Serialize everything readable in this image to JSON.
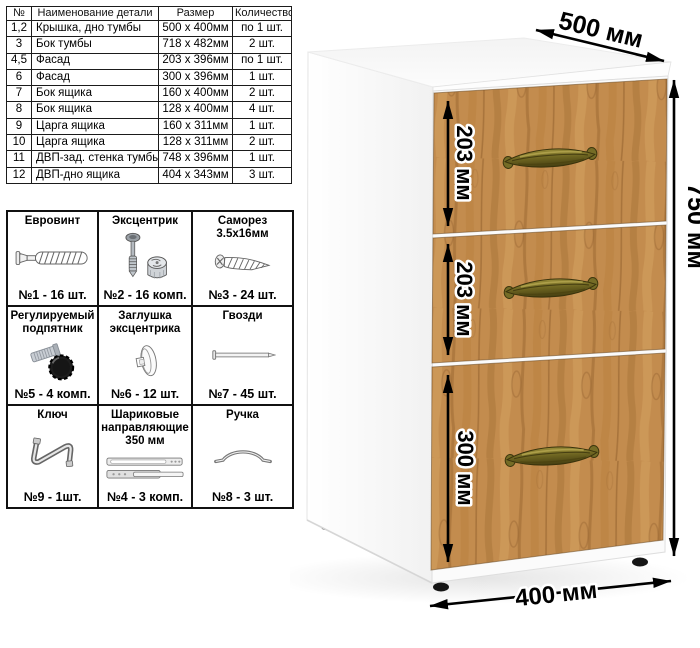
{
  "parts_table": {
    "headers": [
      "№",
      "Наименование детали",
      "Размер",
      "Количество"
    ],
    "rows": [
      [
        "1,2",
        "Крышка, дно тумбы",
        "500 х 400мм",
        "по 1 шт."
      ],
      [
        "3",
        "Бок тумбы",
        "718 х 482мм",
        "2 шт."
      ],
      [
        "4,5",
        "Фасад",
        "203 х 396мм",
        "по 1 шт."
      ],
      [
        "6",
        "Фасад",
        "300 х 396мм",
        "1 шт."
      ],
      [
        "7",
        "Бок ящика",
        "160 х 400мм",
        "2 шт."
      ],
      [
        "8",
        "Бок ящика",
        "128 х 400мм",
        "4 шт."
      ],
      [
        "9",
        "Царга ящика",
        "160 х 311мм",
        "1 шт."
      ],
      [
        "10",
        "Царга ящика",
        "128 х 311мм",
        "2 шт."
      ],
      [
        "11",
        "ДВП-зад. стенка тумбы",
        "748 х 396мм",
        "1 шт."
      ],
      [
        "12",
        "ДВП-дно ящика",
        "404 х 343мм",
        "3 шт."
      ]
    ]
  },
  "hardware": {
    "items": [
      {
        "title": "Евровинт",
        "count": "№1 - 16 шт.",
        "icon": "confirmat-screw"
      },
      {
        "title": "Эксцентрик",
        "count": "№2 - 16 комп.",
        "icon": "eccentric-cam"
      },
      {
        "title": "Саморез 3.5х16мм",
        "count": "№3 - 24 шт.",
        "icon": "self-tapping-screw"
      },
      {
        "title": "Регулируемый подпятник",
        "count": "№5 - 4 комп.",
        "icon": "adjustable-foot"
      },
      {
        "title": "Заглушка эксцентрика",
        "count": "№6 - 12 шт.",
        "icon": "cam-cover"
      },
      {
        "title": "Гвозди",
        "count": "№7 - 45 шт.",
        "icon": "nail"
      },
      {
        "title": "Ключ",
        "count": "№9 - 1шт.",
        "icon": "hex-key"
      },
      {
        "title": "Шариковые направляющие 350 мм",
        "count": "№4 - 3 комп.",
        "icon": "ball-bearing-slides"
      },
      {
        "title": "Ручка",
        "count": "№8 - 3 шт.",
        "icon": "bow-handle"
      }
    ]
  },
  "cabinet": {
    "dims": {
      "depth": "500 мм",
      "height": "750 мм",
      "width": "400 мм",
      "drawers": [
        "203 мм",
        "203 мм",
        "300 мм"
      ]
    },
    "colors": {
      "wood": "#c38c4e",
      "handle_brass": "#6c6320",
      "body": "#ffffff",
      "dimension_lines": "#000000"
    }
  }
}
